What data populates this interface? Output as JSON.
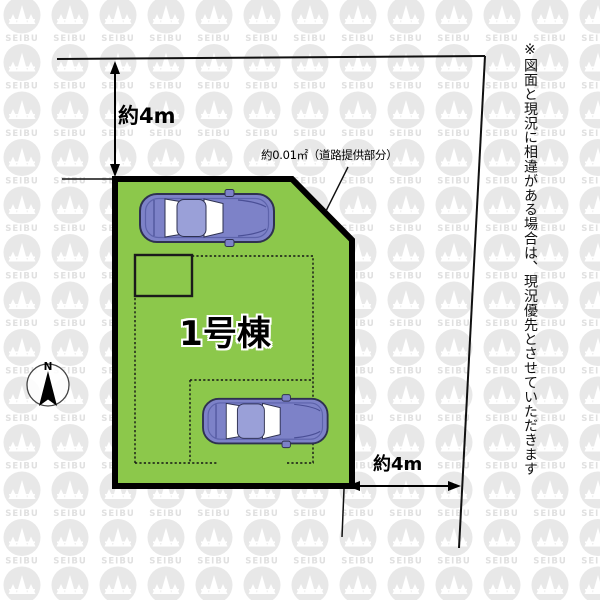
{
  "watermark": {
    "text": "SEIBU"
  },
  "compass": {
    "label": "N"
  },
  "plan": {
    "building_label": "1号棟",
    "road_note": "約0.01㎡（道路提供部分）",
    "dimension_top": "約4m",
    "dimension_bottom": "約4m",
    "disclaimer": "※図面と現況に相違がある場合は、現況優先とさせていただきます"
  },
  "colors": {
    "plot_fill": "#8cc84b",
    "plot_border": "#000000",
    "line_color": "#111111",
    "car_body": "#7d82c8",
    "car_roof": "#9aa0d8",
    "car_outline": "#2e3150",
    "watermark_gray": "#e8e8e8",
    "background": "#ffffff"
  }
}
